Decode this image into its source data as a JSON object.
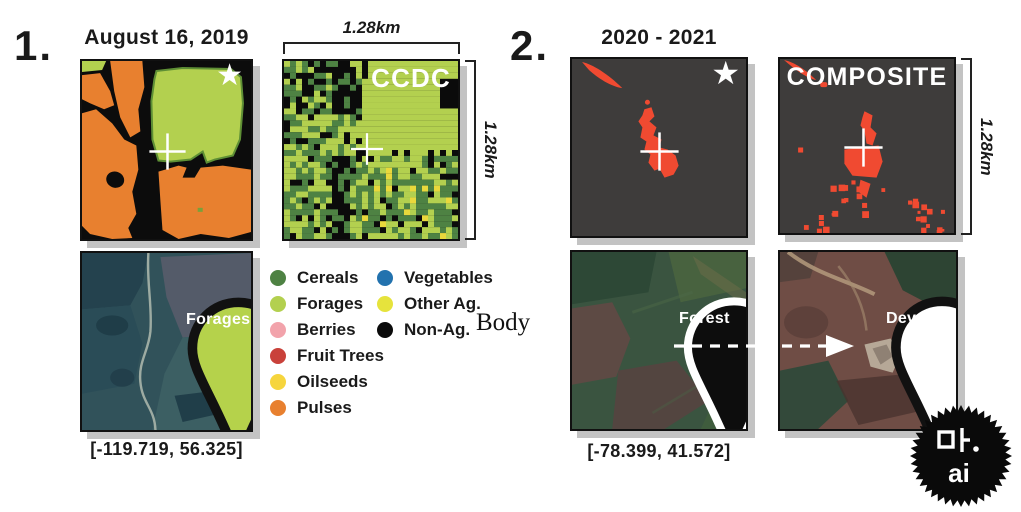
{
  "panel1": {
    "index_label": "1.",
    "title": "August 16, 2019",
    "classification_map": {
      "star": "★"
    },
    "ccdc_map": {
      "label": "CCDC"
    },
    "scale": {
      "top": "1.28km",
      "right": "1.28km"
    },
    "satellite": {
      "pin_label": "Forages"
    },
    "coordinates": "[-119.719, 56.325]"
  },
  "legend": {
    "column1": [
      {
        "label": "Cereals",
        "color": "#4e8243"
      },
      {
        "label": "Forages",
        "color": "#b3d04f"
      },
      {
        "label": "Berries",
        "color": "#f2a3ab"
      },
      {
        "label": "Fruit Trees",
        "color": "#c9413a"
      },
      {
        "label": "Oilseeds",
        "color": "#f6d53d"
      },
      {
        "label": "Pulses",
        "color": "#e8802f"
      }
    ],
    "column2": [
      {
        "label": "Vegetables",
        "color": "#2272ae"
      },
      {
        "label": "Other Ag.",
        "color": "#e6e33c"
      },
      {
        "label": "Non-Ag.",
        "color": "#0a0a0a"
      }
    ],
    "artifact_text": "Body"
  },
  "panel2": {
    "index_label": "2.",
    "title": "2020 - 2021",
    "change_map": {
      "star": "★"
    },
    "composite_map": {
      "label": "COMPOSITE"
    },
    "scale": {
      "right": "1.28km"
    },
    "satellite_before": {
      "pin_label": "Forest"
    },
    "satellite_after": {
      "pin_label": "Developed"
    },
    "coordinates": "[-78.399, 41.572]"
  },
  "badge": {
    "line1": "마.",
    "line2": "ai"
  },
  "colors": {
    "change_red": "#f04a31",
    "map_dark_bg": "#3e3c3b",
    "pixel_black": "#0b0b0b",
    "panel_shadow": "#c3c3c3"
  }
}
